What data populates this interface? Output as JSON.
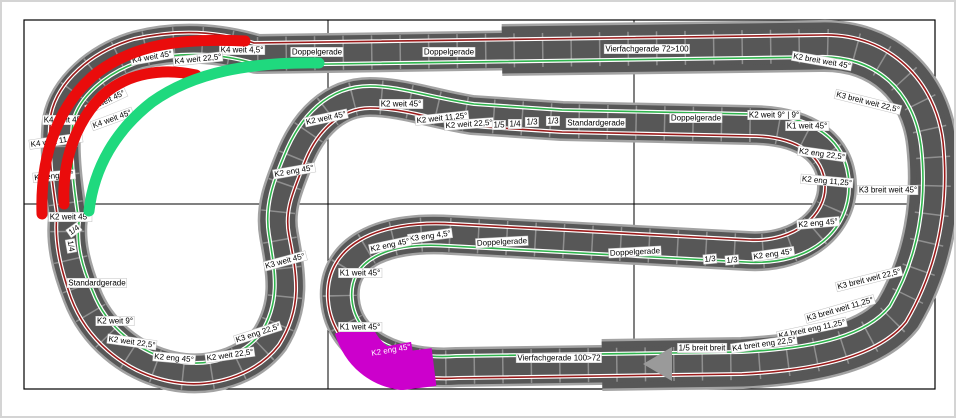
{
  "app": {
    "view_title": "slot-car track plan canvas",
    "grid": {
      "vertical_lines_x": [
        326,
        632
      ],
      "horizontal_lines_y": [
        202
      ]
    }
  },
  "colors": {
    "road": "#575757",
    "road_border": "#a3a3a3",
    "tile_joint": "#8f8f8f",
    "lane_red": "#9b1b1b",
    "lane_green": "#2fb54d",
    "selection_red": "#ea0c0c",
    "selection_green": "#1fd97e",
    "magenta": "#cc00cc",
    "canvas_border": "#000000"
  },
  "selections": [
    {
      "name": "selection-outer-lane",
      "color_key": "selection_red"
    },
    {
      "name": "selection-inner-lane-short",
      "color_key": "selection_red"
    },
    {
      "name": "selection-green-lane",
      "color_key": "selection_green"
    },
    {
      "name": "selection-magenta-piece",
      "color_key": "magenta"
    }
  ],
  "labels": [
    {
      "t": "Doppelgerade",
      "x": 315,
      "y": 50,
      "r": 0
    },
    {
      "t": "Doppelgerade",
      "x": 447,
      "y": 50,
      "r": 0
    },
    {
      "t": "Vierfachgerade 72>100",
      "x": 645,
      "y": 47,
      "r": 0
    },
    {
      "t": "K2 breit weit 45°",
      "x": 820,
      "y": 59,
      "r": 10
    },
    {
      "t": "K3 breit weit 22,5°",
      "x": 866,
      "y": 100,
      "r": 14
    },
    {
      "t": "K4 weit 4,5°",
      "x": 240,
      "y": 48,
      "r": 0
    },
    {
      "t": "K4 weit 22,5°",
      "x": 196,
      "y": 57,
      "r": -6
    },
    {
      "t": "K4 weit 45°",
      "x": 150,
      "y": 55,
      "r": -10
    },
    {
      "t": "K2 weit 45°",
      "x": 104,
      "y": 99,
      "r": -25
    },
    {
      "t": "K4 weit 45°",
      "x": 110,
      "y": 117,
      "r": -20
    },
    {
      "t": "K4 weit 45°",
      "x": 62,
      "y": 118,
      "r": 0
    },
    {
      "t": "K4 weit 11,25°",
      "x": 54,
      "y": 139,
      "r": -8
    },
    {
      "t": "K2 eng 45°",
      "x": 52,
      "y": 174,
      "r": -5
    },
    {
      "t": "K2 weit 45°",
      "x": 68,
      "y": 215,
      "r": 0
    },
    {
      "t": "1/4",
      "x": 72,
      "y": 228,
      "r": -35
    },
    {
      "t": "1/4",
      "x": 69,
      "y": 244,
      "r": 80
    },
    {
      "t": "Standardgerade",
      "x": 95,
      "y": 281,
      "r": 0
    },
    {
      "t": "K2 weit 9°",
      "x": 113,
      "y": 319,
      "r": 0
    },
    {
      "t": "K2 weit 22,5°",
      "x": 130,
      "y": 340,
      "r": 8
    },
    {
      "t": "K2 eng 45°",
      "x": 172,
      "y": 356,
      "r": 5
    },
    {
      "t": "K2 weit 22,5°",
      "x": 228,
      "y": 353,
      "r": -8
    },
    {
      "t": "K3 eng 22,5°",
      "x": 256,
      "y": 331,
      "r": -18
    },
    {
      "t": "K3 weit 45°",
      "x": 283,
      "y": 259,
      "r": -15
    },
    {
      "t": "K2 eng 45°",
      "x": 292,
      "y": 169,
      "r": -10
    },
    {
      "t": "K2 weit 45°",
      "x": 324,
      "y": 116,
      "r": -12
    },
    {
      "t": "K2 weit 45°",
      "x": 399,
      "y": 102,
      "r": 0
    },
    {
      "t": "K2 weit 11,25°",
      "x": 440,
      "y": 116,
      "r": -6
    },
    {
      "t": "K2 weit 22,5°",
      "x": 467,
      "y": 122,
      "r": -4
    },
    {
      "t": "1/5",
      "x": 497,
      "y": 123,
      "r": 0
    },
    {
      "t": "1/4",
      "x": 513,
      "y": 122,
      "r": 0
    },
    {
      "t": "1/3",
      "x": 530,
      "y": 120,
      "r": 0
    },
    {
      "t": "1/3",
      "x": 551,
      "y": 119,
      "r": 0
    },
    {
      "t": "Standardgerade",
      "x": 594,
      "y": 121,
      "r": 0
    },
    {
      "t": "Doppelgerade",
      "x": 694,
      "y": 116,
      "r": 0
    },
    {
      "t": "K2 weit 9° | 9°",
      "x": 772,
      "y": 113,
      "r": 0
    },
    {
      "t": "K1 weit 45°",
      "x": 805,
      "y": 124,
      "r": 0
    },
    {
      "t": "K2 eng 22,5°",
      "x": 820,
      "y": 152,
      "r": 8
    },
    {
      "t": "K2 eng 11,25°",
      "x": 825,
      "y": 179,
      "r": 5
    },
    {
      "t": "K3 breit weit 45°",
      "x": 886,
      "y": 188,
      "r": 0
    },
    {
      "t": "K2 eng 45°",
      "x": 816,
      "y": 221,
      "r": -5
    },
    {
      "t": "K2 eng 45°",
      "x": 771,
      "y": 252,
      "r": -8
    },
    {
      "t": "1/3",
      "x": 708,
      "y": 257,
      "r": -5
    },
    {
      "t": "1/3",
      "x": 730,
      "y": 258,
      "r": -5
    },
    {
      "t": "Doppelgerade",
      "x": 633,
      "y": 250,
      "r": -3
    },
    {
      "t": "Doppelgerade",
      "x": 500,
      "y": 240,
      "r": -3
    },
    {
      "t": "K3 eng 4,5°",
      "x": 428,
      "y": 234,
      "r": -8
    },
    {
      "t": "K2 eng 45°",
      "x": 388,
      "y": 243,
      "r": -12
    },
    {
      "t": "K1 weit 45°",
      "x": 358,
      "y": 271,
      "r": 0
    },
    {
      "t": "K1 weit 45°",
      "x": 358,
      "y": 325,
      "r": 0
    },
    {
      "t": "K2 eng 45°",
      "x": 389,
      "y": 348,
      "r": -10,
      "v": "magenta"
    },
    {
      "t": "Vierfachgerade 100>72",
      "x": 557,
      "y": 356,
      "r": 0
    },
    {
      "t": "K3 breit weit 22,5°",
      "x": 867,
      "y": 277,
      "r": -14
    },
    {
      "t": "K3 breit weit 11,25°",
      "x": 838,
      "y": 307,
      "r": -16
    },
    {
      "t": "K4 breit eng 11,25°",
      "x": 810,
      "y": 327,
      "r": -12
    },
    {
      "t": "K4 breit eng 22,5°",
      "x": 762,
      "y": 342,
      "r": -8
    },
    {
      "t": "1/5 breit breit",
      "x": 700,
      "y": 346,
      "r": 0
    }
  ]
}
